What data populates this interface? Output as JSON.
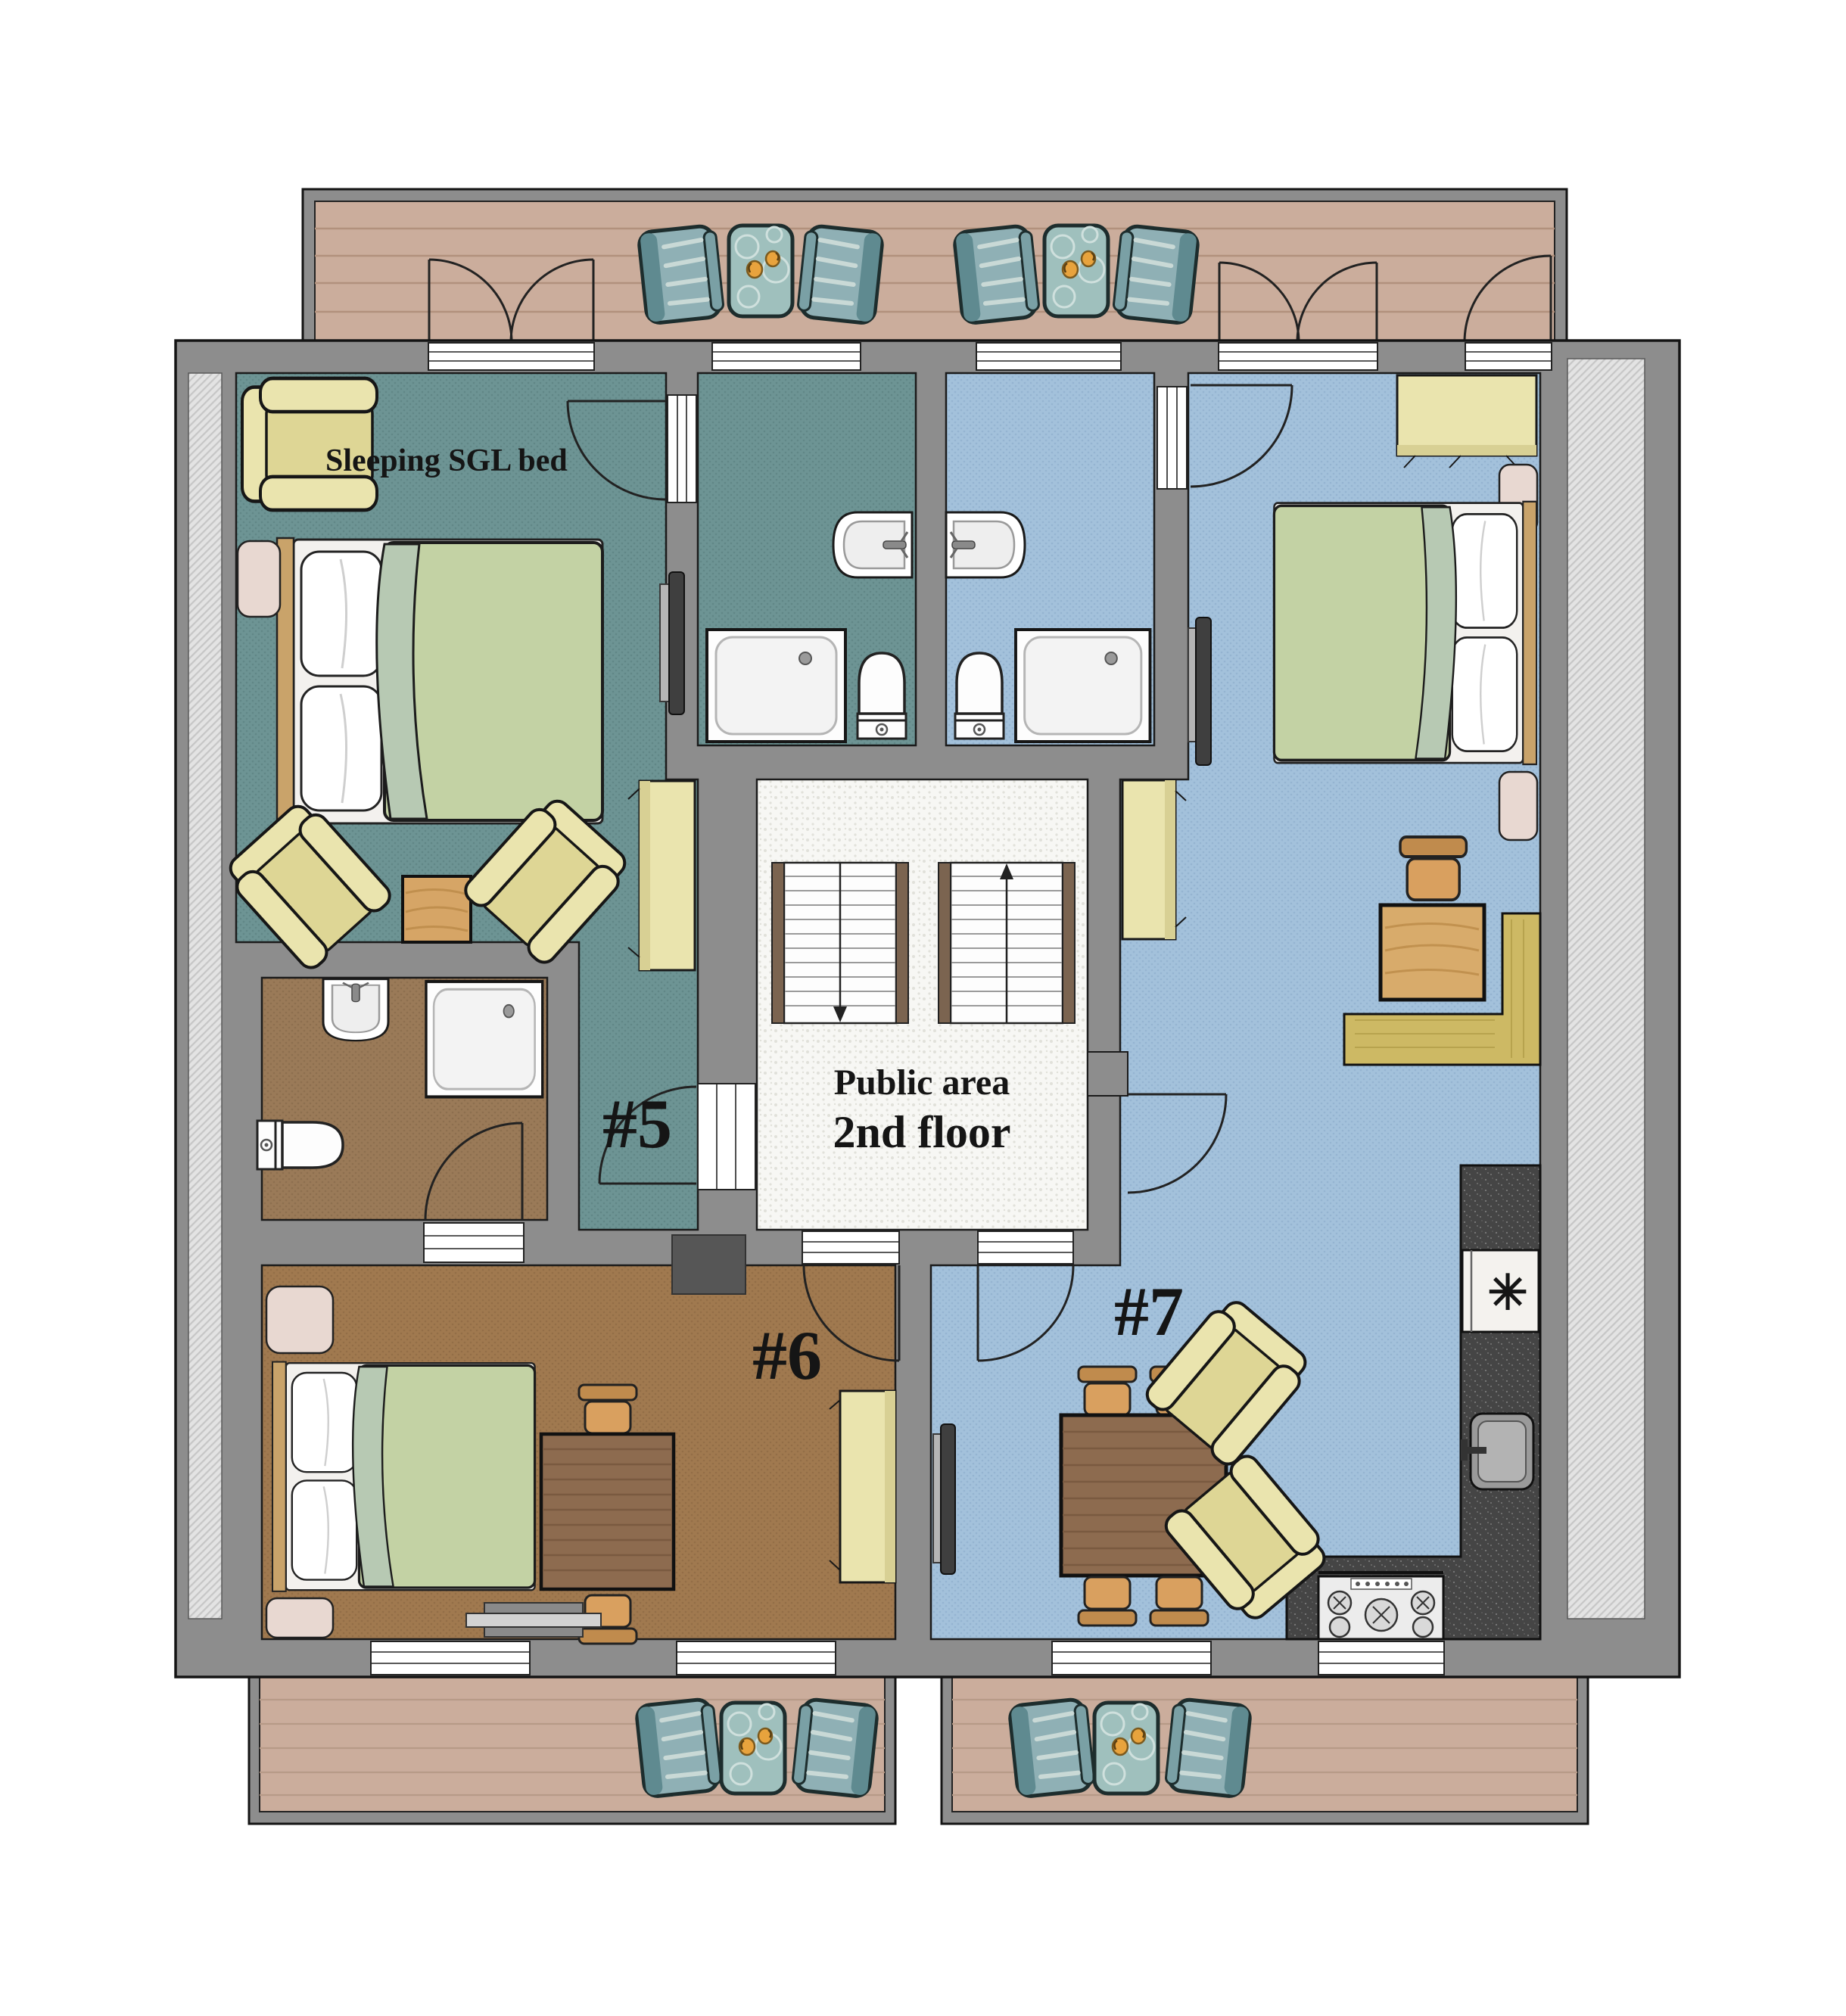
{
  "floorplan": {
    "annotations": {
      "sleeping_note": "Sleeping SGL bed",
      "public_area_line1": "Public area",
      "public_area_line2": "2nd floor",
      "room5_label": "#5",
      "room6_label": "#6",
      "room7_label": "#7",
      "freezer_symbol": "✳"
    },
    "colors": {
      "wall": "#8d8d8d",
      "hatch_base": "#e3e3e3",
      "room5_floor": "#6d9494",
      "room5_floor_dot": "#618787",
      "room7_floor": "#a3c1db",
      "room7_floor_dot": "#95b4d1",
      "room6_floor": "#a0794f",
      "room6_floor_dot": "#936e47",
      "bathroom6_floor": "#9a7a58",
      "bathroom6_floor_dot": "#8d6f4f",
      "public_floor": "#f7f7f4",
      "public_floor_dot": "#e1e1da",
      "balcony_wood": "#cbad9c",
      "furniture_yellow": "#eae4ae",
      "duvet_green": "#c3d2a4",
      "balcony_chair_teal": "#8fb0b5",
      "balcony_table_teal": "#9fc0bd",
      "counter_dark": "#454545",
      "doormat": "#565656"
    }
  }
}
